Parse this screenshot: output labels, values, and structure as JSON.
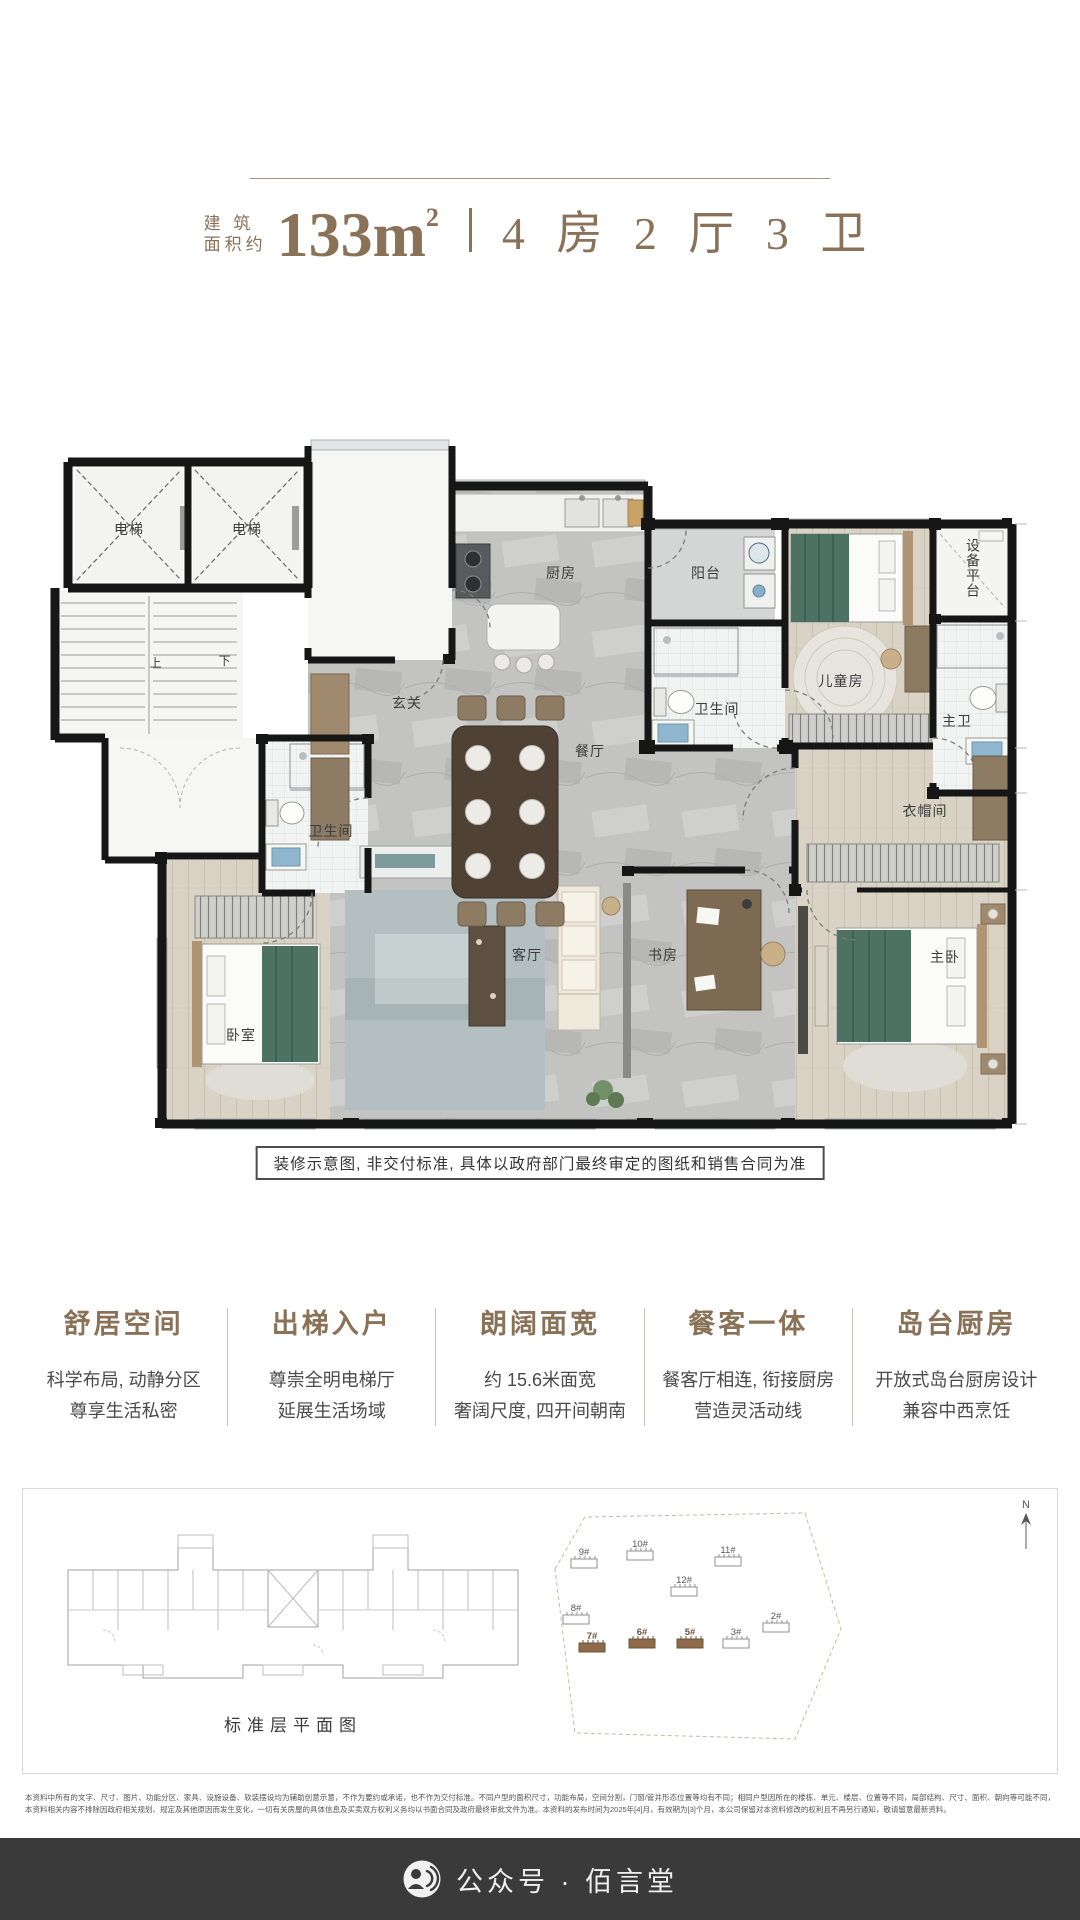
{
  "header": {
    "area_prefix_top": "建 筑",
    "area_prefix_bottom": "面积约",
    "area_value": "133m",
    "area_sup": "2",
    "layout_text": "4 房 2 厅 3 卫"
  },
  "floorplan": {
    "labels": {
      "elevator1": "电梯",
      "elevator2": "电梯",
      "up": "上",
      "down": "下",
      "kitchen": "厨房",
      "balcony": "阳台",
      "kids": "儿童房",
      "equipment": "设备平台",
      "bath_mid": "卫生间",
      "master_bath": "主卫",
      "foyer": "玄关",
      "dining": "餐厅",
      "bath_left": "卫生间",
      "cloakroom": "衣帽间",
      "bedroom": "卧室",
      "living": "客厅",
      "study": "书房",
      "master": "主卧"
    },
    "note": "装修示意图, 非交付标准, 具体以政府部门最终审定的图纸和销售合同为准"
  },
  "features": [
    {
      "title": "舒居空间",
      "line1": "科学布局, 动静分区",
      "line2": "尊享生活私密"
    },
    {
      "title": "出梯入户",
      "line1": "尊崇全明电梯厅",
      "line2": "延展生活场域"
    },
    {
      "title": "朗阔面宽",
      "line1": "约 15.6米面宽",
      "line2": "奢阔尺度, 四开间朝南"
    },
    {
      "title": "餐客一体",
      "line1": "餐客厅相连, 衔接厨房",
      "line2": "营造灵活动线"
    },
    {
      "title": "岛台厨房",
      "line1": "开放式岛台厨房设计",
      "line2": "兼容中西烹饪"
    }
  ],
  "bottom_panel": {
    "caption": "标准层平面图",
    "compass_label": "N",
    "buildings": [
      {
        "label": "9#",
        "highlight": false
      },
      {
        "label": "10#",
        "highlight": false
      },
      {
        "label": "11#",
        "highlight": false
      },
      {
        "label": "12#",
        "highlight": false
      },
      {
        "label": "8#",
        "highlight": false
      },
      {
        "label": "7#",
        "highlight": true
      },
      {
        "label": "6#",
        "highlight": true
      },
      {
        "label": "5#",
        "highlight": true
      },
      {
        "label": "3#",
        "highlight": false
      },
      {
        "label": "2#",
        "highlight": false
      }
    ]
  },
  "fine_print": {
    "line1": "本资料中所有的文字、尺寸、图片、功能分区、家具、设施设备、软装摆设均为辅助创意示意，不作为要约或承诺，也不作为交付标准。不同户型的面积尺寸，功能布局，空间分割，门窗/管井形态位置等均有不同；相同户型因所在的楼栋、单元、楼层、位置等不同，局部结构、尺寸、面积、朝向等可能不同，",
    "line2": "本资料相关内容不排除因政府相关规划、规定及其他原因而发生变化，一切有关房屋的具体信息及买卖双方权利义务均以书面合同及政府最终审批文件为准。本资料的发布时间为2025年[4]月，有效期为[3]个月，本公司保留对本资料修改的权利且不再另行通知，敬请留意最新资料。"
  },
  "footer": {
    "account_text": "公众号 · 佰言堂"
  },
  "colors": {
    "accent_brown": "#8a7258",
    "wall_black": "#161616",
    "bed_green": "#4c7264",
    "building_highlight": "#8d6b4a",
    "footer_bg": "#3a3a3a"
  }
}
